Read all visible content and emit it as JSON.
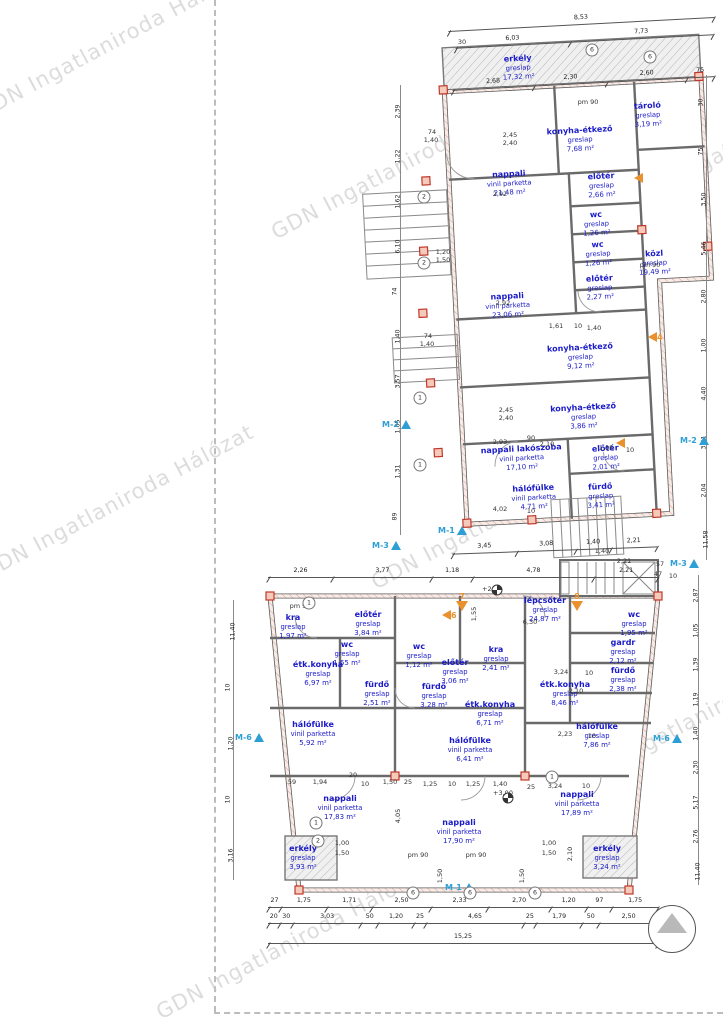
{
  "watermark": {
    "text": "GDN Ingatlaniroda Hálózat",
    "color": "#c7c7c7",
    "positions": [
      {
        "x": -40,
        "y": 30
      },
      {
        "x": 255,
        "y": 150
      },
      {
        "x": -35,
        "y": 490
      },
      {
        "x": 355,
        "y": 500
      },
      {
        "x": 555,
        "y": 700
      },
      {
        "x": 140,
        "y": 930
      },
      {
        "x": 610,
        "y": 120
      }
    ]
  },
  "colors": {
    "room_label": "#1b1bc8",
    "marker_blue": "#2e9fd4",
    "marker_orange": "#e8912d",
    "column_red": "#c0392b",
    "wall": "#5b5b5b",
    "hatch_pink": "#dba493"
  },
  "plans": {
    "upper": {
      "name": "upper-floor-plan",
      "rooms": [
        {
          "name": "erkély",
          "finish": "greslap",
          "area": "17,32 m²",
          "x": 170,
          "y": 38
        },
        {
          "name": "konyha-étkező",
          "finish": "greslap",
          "area": "7,68 m²",
          "x": 228,
          "y": 113
        },
        {
          "name": "tároló",
          "finish": "greslap",
          "area": "3,19 m²",
          "x": 297,
          "y": 92
        },
        {
          "name": "nappali",
          "finish": "vinil parketta",
          "area": "21,48 m²",
          "x": 155,
          "y": 153
        },
        {
          "name": "előtér",
          "finish": "greslap",
          "area": "2,66 m²",
          "x": 247,
          "y": 160
        },
        {
          "name": "wc",
          "finish": "greslap",
          "area": "1,26 m²",
          "x": 240,
          "y": 198
        },
        {
          "name": "wc",
          "finish": "greslap",
          "area": "1,26 m²",
          "x": 240,
          "y": 228
        },
        {
          "name": "közl",
          "finish": "greslap",
          "area": "19,49 m²",
          "x": 296,
          "y": 240
        },
        {
          "name": "előtér",
          "finish": "greslap",
          "area": "2,27 m²",
          "x": 240,
          "y": 262
        },
        {
          "name": "nappali",
          "finish": "vinil parketta",
          "area": "23,06 m²",
          "x": 147,
          "y": 275
        },
        {
          "name": "konyha-étkező",
          "finish": "greslap",
          "area": "9,12 m²",
          "x": 217,
          "y": 330
        },
        {
          "name": "konyha-étkező",
          "finish": "greslap",
          "area": "3,86 m²",
          "x": 217,
          "y": 390
        },
        {
          "name": "nappali lakószoba",
          "finish": "vinil parketta",
          "area": "17,10 m²",
          "x": 153,
          "y": 428
        },
        {
          "name": "előtér",
          "finish": "greslap",
          "area": "2,01 m²",
          "x": 237,
          "y": 432
        },
        {
          "name": "hálófülke",
          "finish": "vinil parketta",
          "area": "4,71 m²",
          "x": 163,
          "y": 468
        },
        {
          "name": "fürdő",
          "finish": "greslap",
          "area": "3,41 m²",
          "x": 230,
          "y": 470
        }
      ]
    },
    "lower": {
      "name": "lower-floor-plan",
      "rooms": [
        {
          "name": "lépcsőtér",
          "finish": "greslap",
          "area": "24,87 m²",
          "x": 320,
          "y": 38
        },
        {
          "name": "kra",
          "finish": "greslap",
          "area": "1,97 m²",
          "x": 68,
          "y": 55
        },
        {
          "name": "előtér",
          "finish": "greslap",
          "area": "3,84 m²",
          "x": 143,
          "y": 52
        },
        {
          "name": "wc",
          "finish": "greslap",
          "area": "1,55 m²",
          "x": 122,
          "y": 82
        },
        {
          "name": "étk.konyha",
          "finish": "greslap",
          "area": "6,97 m²",
          "x": 93,
          "y": 102
        },
        {
          "name": "fürdő",
          "finish": "greslap",
          "area": "2,51 m²",
          "x": 152,
          "y": 122
        },
        {
          "name": "hálófülke",
          "finish": "vinil parketta",
          "area": "5,92 m²",
          "x": 88,
          "y": 162
        },
        {
          "name": "nappali",
          "finish": "vinil parketta",
          "area": "17,83 m²",
          "x": 115,
          "y": 236
        },
        {
          "name": "erkély",
          "finish": "greslap",
          "area": "3,93 m²",
          "x": 78,
          "y": 286
        },
        {
          "name": "wc",
          "finish": "greslap",
          "area": "1,12 m²",
          "x": 194,
          "y": 84
        },
        {
          "name": "fürdő",
          "finish": "greslap",
          "area": "3,28 m²",
          "x": 209,
          "y": 124
        },
        {
          "name": "kra",
          "finish": "greslap",
          "area": "2,41 m²",
          "x": 271,
          "y": 87
        },
        {
          "name": "előtér",
          "finish": "greslap",
          "area": "3,06 m²",
          "x": 230,
          "y": 100
        },
        {
          "name": "étk.konyha",
          "finish": "greslap",
          "area": "6,71 m²",
          "x": 265,
          "y": 142
        },
        {
          "name": "hálófülke",
          "finish": "vinil parketta",
          "area": "6,41 m²",
          "x": 245,
          "y": 178
        },
        {
          "name": "nappali",
          "finish": "vinil parketta",
          "area": "17,90 m²",
          "x": 234,
          "y": 260
        },
        {
          "name": "wc",
          "finish": "greslap",
          "area": "1,95 m²",
          "x": 409,
          "y": 52
        },
        {
          "name": "gardr",
          "finish": "greslap",
          "area": "2,12 m²",
          "x": 398,
          "y": 80
        },
        {
          "name": "fürdő",
          "finish": "greslap",
          "area": "2,38 m²",
          "x": 398,
          "y": 108
        },
        {
          "name": "étk.konyha",
          "finish": "greslap",
          "area": "8,46 m²",
          "x": 340,
          "y": 122
        },
        {
          "name": "hálófülke",
          "finish": "greslap",
          "area": "7,86 m²",
          "x": 372,
          "y": 164
        },
        {
          "name": "nappali",
          "finish": "vinil parketta",
          "area": "17,89 m²",
          "x": 352,
          "y": 232
        },
        {
          "name": "erkély",
          "finish": "greslap",
          "area": "3,24 m²",
          "x": 382,
          "y": 286
        }
      ]
    }
  },
  "dim_rows": [
    {
      "x": 448,
      "y": 14,
      "w": 266,
      "rot": -3,
      "values": [
        "8,53"
      ]
    },
    {
      "x": 455,
      "y": 31,
      "w": 258,
      "rot": -3,
      "values": [
        "6,03",
        "7,73"
      ]
    },
    {
      "x": 452,
      "y": 73,
      "w": 262,
      "rot": -3,
      "values": [
        "2,68",
        "2,30",
        "2,60",
        "75"
      ]
    },
    {
      "x": 452,
      "y": 540,
      "w": 205,
      "rot": -2,
      "values": [
        "3,45",
        "3,08",
        "1,40",
        "2,21"
      ]
    },
    {
      "x": 268,
      "y": 567,
      "w": 390,
      "rot": 0,
      "values": [
        "2,26",
        "3,77",
        "1,18",
        "4,78",
        "2,21"
      ]
    },
    {
      "x": 268,
      "y": 897,
      "w": 390,
      "rot": 0,
      "values": [
        "27",
        "1,75",
        "1,71",
        "2,50",
        "2,33",
        "2,70",
        "1,20",
        "97",
        "1,75"
      ]
    },
    {
      "x": 268,
      "y": 913,
      "w": 390,
      "rot": 0,
      "values": [
        "20",
        "30",
        "3,03",
        "50",
        "1,20",
        "25",
        "4,65",
        "25",
        "1,79",
        "50",
        "2,50"
      ]
    },
    {
      "x": 268,
      "y": 933,
      "w": 390,
      "rot": 0,
      "values": [
        "15,25"
      ]
    }
  ],
  "dim_columns": [
    {
      "x": 400,
      "y1": 85,
      "y2": 535,
      "values": [
        "2,39",
        "1,22",
        "1,62",
        "6,10",
        "74",
        "1,40",
        "3,57",
        "1,65",
        "1,31",
        "89"
      ]
    },
    {
      "x": 706,
      "y1": 75,
      "y2": 560,
      "values": [
        "30",
        "75",
        "3,50",
        "5,46",
        "2,80",
        "1,00",
        "4,40",
        "3,41",
        "2,04",
        "11,58"
      ]
    },
    {
      "x": 698,
      "y1": 575,
      "y2": 885,
      "values": [
        "2,87",
        "1,05",
        "1,39",
        "1,19",
        "1,40",
        "2,30",
        "5,17",
        "2,76",
        "11,40"
      ]
    },
    {
      "x": 233,
      "y1": 600,
      "y2": 880,
      "values": [
        "11,40",
        "10",
        "1,20",
        "10",
        "3,16"
      ]
    }
  ],
  "annotations": [
    {
      "t": "30",
      "x": 462,
      "y": 38
    },
    {
      "t": "2,45",
      "x": 510,
      "y": 131
    },
    {
      "t": "2,40",
      "x": 510,
      "y": 139
    },
    {
      "t": "74",
      "x": 432,
      "y": 128
    },
    {
      "t": "1,40",
      "x": 431,
      "y": 136
    },
    {
      "t": "2,92",
      "x": 500,
      "y": 190
    },
    {
      "t": "pm 90",
      "x": 588,
      "y": 98
    },
    {
      "t": "1,20",
      "x": 443,
      "y": 248
    },
    {
      "t": "1,50",
      "x": 443,
      "y": 256
    },
    {
      "t": "2,92",
      "x": 503,
      "y": 299
    },
    {
      "t": "1,61",
      "x": 556,
      "y": 322
    },
    {
      "t": "10",
      "x": 578,
      "y": 322
    },
    {
      "t": "1,40",
      "x": 594,
      "y": 324
    },
    {
      "t": "2,45",
      "x": 506,
      "y": 406
    },
    {
      "t": "2,40",
      "x": 506,
      "y": 414
    },
    {
      "t": "74",
      "x": 428,
      "y": 332
    },
    {
      "t": "1,40",
      "x": 427,
      "y": 340
    },
    {
      "t": "2,93",
      "x": 500,
      "y": 438
    },
    {
      "t": "90",
      "x": 531,
      "y": 434
    },
    {
      "t": "2,10",
      "x": 547,
      "y": 440
    },
    {
      "t": "1,05",
      "x": 606,
      "y": 444
    },
    {
      "t": "10",
      "x": 630,
      "y": 446
    },
    {
      "t": "4,02",
      "x": 500,
      "y": 505
    },
    {
      "t": "10",
      "x": 531,
      "y": 507
    },
    {
      "t": "pm 90",
      "x": 650,
      "y": 261
    },
    {
      "t": "57",
      "x": 660,
      "y": 560
    },
    {
      "t": "47",
      "x": 658,
      "y": 570
    },
    {
      "t": "10",
      "x": 673,
      "y": 572
    },
    {
      "t": "1,40",
      "x": 602,
      "y": 547
    },
    {
      "t": "2,21",
      "x": 624,
      "y": 557
    },
    {
      "t": "+2,99",
      "x": 492,
      "y": 585
    },
    {
      "t": "6,30",
      "x": 530,
      "y": 618
    },
    {
      "t": "1,55",
      "x": 474,
      "y": 610,
      "v": true
    },
    {
      "t": "pm 90",
      "x": 300,
      "y": 602
    },
    {
      "t": "3,24",
      "x": 561,
      "y": 668
    },
    {
      "t": "10",
      "x": 589,
      "y": 669
    },
    {
      "t": "2,10",
      "x": 576,
      "y": 687
    },
    {
      "t": "2,23",
      "x": 565,
      "y": 730
    },
    {
      "t": "10",
      "x": 592,
      "y": 732
    },
    {
      "t": "59",
      "x": 292,
      "y": 778
    },
    {
      "t": "1,94",
      "x": 320,
      "y": 778
    },
    {
      "t": "20",
      "x": 353,
      "y": 771
    },
    {
      "t": "10",
      "x": 365,
      "y": 780
    },
    {
      "t": "1,50",
      "x": 390,
      "y": 778
    },
    {
      "t": "25",
      "x": 408,
      "y": 778
    },
    {
      "t": "1,25",
      "x": 430,
      "y": 780
    },
    {
      "t": "10",
      "x": 452,
      "y": 780
    },
    {
      "t": "1,25",
      "x": 473,
      "y": 780
    },
    {
      "t": "1,40",
      "x": 500,
      "y": 780
    },
    {
      "t": "25",
      "x": 531,
      "y": 783
    },
    {
      "t": "3,24",
      "x": 555,
      "y": 782
    },
    {
      "t": "10",
      "x": 586,
      "y": 782
    },
    {
      "t": "+3,00",
      "x": 503,
      "y": 789
    },
    {
      "t": "1,00",
      "x": 342,
      "y": 839
    },
    {
      "t": "1,50",
      "x": 342,
      "y": 849
    },
    {
      "t": "1,00",
      "x": 549,
      "y": 839
    },
    {
      "t": "1,50",
      "x": 549,
      "y": 849
    },
    {
      "t": "pm 90",
      "x": 418,
      "y": 851
    },
    {
      "t": "pm 90",
      "x": 476,
      "y": 851
    },
    {
      "t": "4,05",
      "x": 398,
      "y": 812,
      "v": true
    },
    {
      "t": "1,50",
      "x": 440,
      "y": 872,
      "v": true
    },
    {
      "t": "1,50",
      "x": 522,
      "y": 872,
      "v": true
    },
    {
      "t": "2,10",
      "x": 570,
      "y": 850,
      "v": true
    }
  ],
  "markers": {
    "section": [
      {
        "label": "M-2",
        "x": 382,
        "y": 420
      },
      {
        "label": "M-3",
        "x": 372,
        "y": 541
      },
      {
        "label": "M-2",
        "x": 680,
        "y": 436
      },
      {
        "label": "M-3",
        "x": 670,
        "y": 559
      },
      {
        "label": "M-6",
        "x": 235,
        "y": 733
      },
      {
        "label": "M-6",
        "x": 653,
        "y": 734
      },
      {
        "label": "M-1",
        "x": 438,
        "y": 526
      },
      {
        "label": "M-1",
        "x": 445,
        "y": 883
      }
    ],
    "view": [
      {
        "label": "4",
        "x": 648,
        "y": 332,
        "dir": "left"
      },
      {
        "label": "6",
        "x": 442,
        "y": 610,
        "dir": "left"
      },
      {
        "label": "7",
        "x": 456,
        "y": 592,
        "dir": "down"
      },
      {
        "label": "8",
        "x": 571,
        "y": 592,
        "dir": "down"
      },
      {
        "label": "",
        "x": 634,
        "y": 173,
        "dir": "left"
      },
      {
        "label": "",
        "x": 616,
        "y": 438,
        "dir": "left"
      }
    ],
    "axis_circles": [
      {
        "n": "6",
        "x": 592,
        "y": 50
      },
      {
        "n": "6",
        "x": 650,
        "y": 57
      },
      {
        "n": "2",
        "x": 424,
        "y": 197
      },
      {
        "n": "2",
        "x": 424,
        "y": 263
      },
      {
        "n": "1",
        "x": 420,
        "y": 398
      },
      {
        "n": "1",
        "x": 420,
        "y": 465
      },
      {
        "n": "1",
        "x": 309,
        "y": 603
      },
      {
        "n": "1",
        "x": 316,
        "y": 823
      },
      {
        "n": "2",
        "x": 318,
        "y": 841
      },
      {
        "n": "6",
        "x": 413,
        "y": 893
      },
      {
        "n": "6",
        "x": 470,
        "y": 893
      },
      {
        "n": "6",
        "x": 535,
        "y": 893
      },
      {
        "n": "1",
        "x": 552,
        "y": 777
      }
    ],
    "levels": [
      {
        "x": 497,
        "y": 590
      },
      {
        "x": 508,
        "y": 798
      }
    ]
  },
  "compass": {
    "name": "north-arrow"
  }
}
